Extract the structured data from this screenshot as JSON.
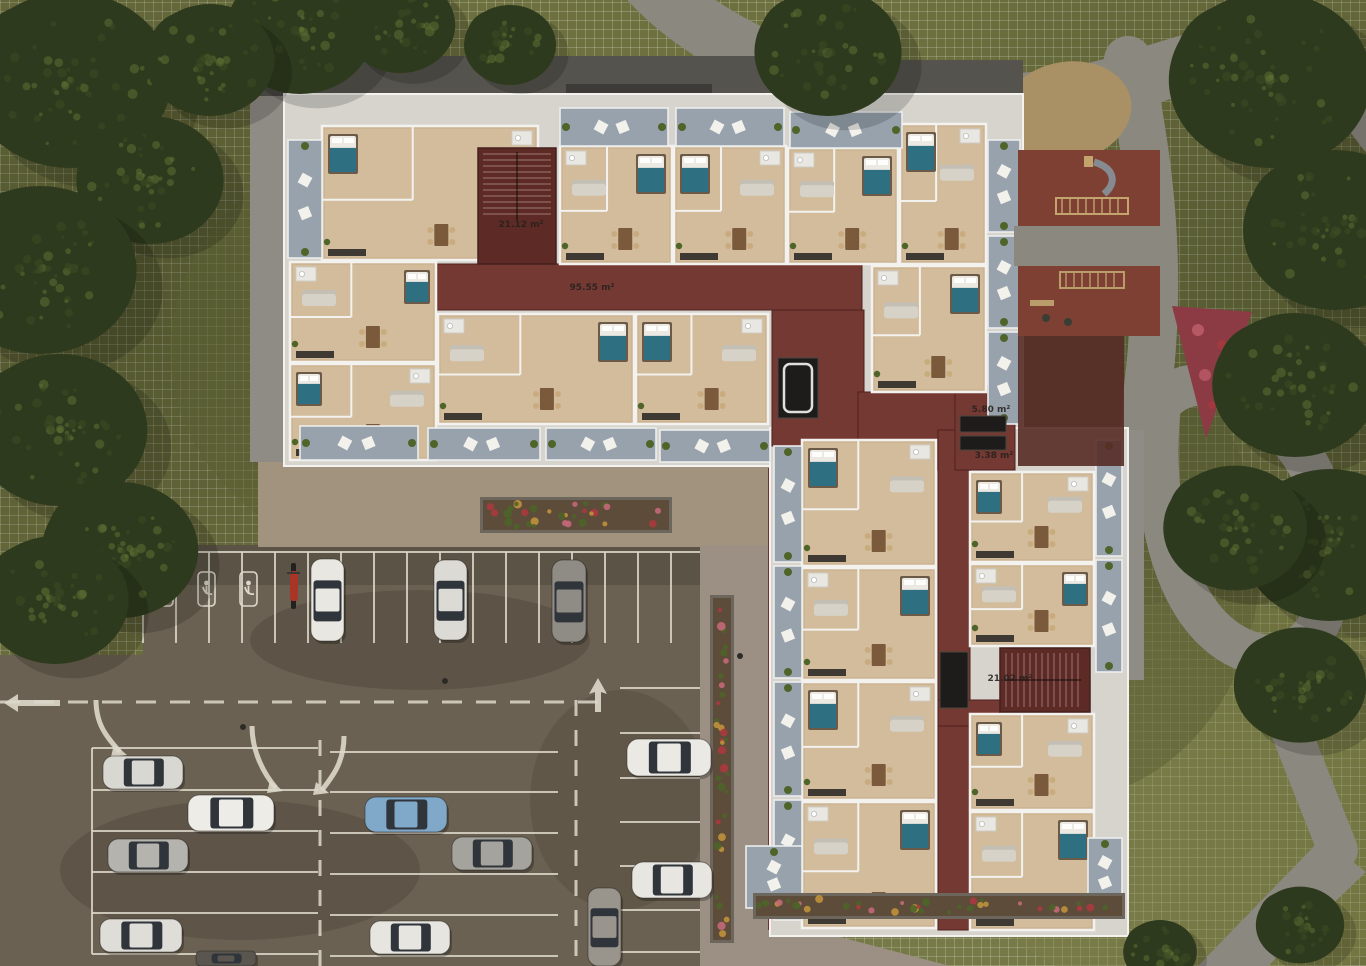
{
  "scene": {
    "width": 1366,
    "height": 966,
    "description": "Aerial 3D architectural rendering of an apartment building floor plan with furnished units, red circulation corridors, playground courtyard, landscaped paths and a car park"
  },
  "palette": {
    "grass": "#6e713f",
    "tree_dark": "#2e3a1d",
    "tree": "#3e4b25",
    "tree_light": "#5e7033",
    "path": "#8b8880",
    "path_dark": "#6f6d66",
    "asphalt": "#6b6152",
    "marking": "#ddd8ca",
    "plaza": "#a2937e",
    "walkway": "#9b9083",
    "wall": "#d7d4cd",
    "wall_line": "#f3f2ef",
    "floor": "#cdb593",
    "floor_light": "#d9c6a7",
    "balcony": "#97a2ac",
    "corridor_red": "#743933",
    "stair_red": "#5d2a26",
    "courtyard_red": "#7f4034",
    "elevator_dark": "#1e1c1a",
    "bed_teal": "#2f6f82",
    "linen_white": "#ece9e2",
    "sofa_gray": "#d6d2c8",
    "wood_brown": "#7a5a3a",
    "kitchen_dark": "#3e3933",
    "soil": "#5c4c39",
    "leaf": "#4e6429",
    "flower_pink": "#c4687a",
    "flower_red": "#a83a3f",
    "flower_yellow": "#c0913c",
    "dirt": "#aa9065",
    "label_text": "#26211d",
    "car_window": "#30353b"
  },
  "area_labels": [
    {
      "text": "95.55 m²",
      "x": 592,
      "y": 290
    },
    {
      "text": "21.12 m²",
      "x": 521,
      "y": 227
    },
    {
      "text": "5.80 m²",
      "x": 991,
      "y": 412
    },
    {
      "text": "3.38 m²",
      "x": 994,
      "y": 458
    },
    {
      "text": "21.02 m²",
      "x": 1010,
      "y": 681
    }
  ],
  "units": [
    {
      "x": 322,
      "y": 126,
      "w": 216,
      "h": 134
    },
    {
      "x": 290,
      "y": 262,
      "w": 146,
      "h": 100
    },
    {
      "x": 290,
      "y": 364,
      "w": 146,
      "h": 96
    },
    {
      "x": 438,
      "y": 314,
      "w": 196,
      "h": 110
    },
    {
      "x": 636,
      "y": 314,
      "w": 132,
      "h": 110
    },
    {
      "x": 560,
      "y": 146,
      "w": 112,
      "h": 118
    },
    {
      "x": 674,
      "y": 146,
      "w": 112,
      "h": 118
    },
    {
      "x": 788,
      "y": 148,
      "w": 110,
      "h": 116
    },
    {
      "x": 900,
      "y": 124,
      "w": 86,
      "h": 140
    },
    {
      "x": 872,
      "y": 266,
      "w": 114,
      "h": 126
    },
    {
      "x": 802,
      "y": 440,
      "w": 134,
      "h": 126
    },
    {
      "x": 802,
      "y": 568,
      "w": 134,
      "h": 112
    },
    {
      "x": 802,
      "y": 682,
      "w": 134,
      "h": 118
    },
    {
      "x": 802,
      "y": 802,
      "w": 134,
      "h": 126
    },
    {
      "x": 970,
      "y": 472,
      "w": 124,
      "h": 90
    },
    {
      "x": 970,
      "y": 564,
      "w": 124,
      "h": 82
    },
    {
      "x": 970,
      "y": 714,
      "w": 124,
      "h": 96
    },
    {
      "x": 970,
      "y": 812,
      "w": 124,
      "h": 118
    }
  ],
  "balconies": [
    {
      "x": 560,
      "y": 108,
      "w": 108,
      "h": 38,
      "o": "h"
    },
    {
      "x": 676,
      "y": 108,
      "w": 108,
      "h": 38,
      "o": "h"
    },
    {
      "x": 790,
      "y": 112,
      "w": 112,
      "h": 36,
      "o": "h"
    },
    {
      "x": 288,
      "y": 140,
      "w": 34,
      "h": 118,
      "o": "v"
    },
    {
      "x": 300,
      "y": 426,
      "w": 118,
      "h": 34,
      "o": "h"
    },
    {
      "x": 428,
      "y": 428,
      "w": 112,
      "h": 32,
      "o": "h"
    },
    {
      "x": 546,
      "y": 428,
      "w": 110,
      "h": 32,
      "o": "h"
    },
    {
      "x": 660,
      "y": 430,
      "w": 110,
      "h": 32,
      "o": "h"
    },
    {
      "x": 988,
      "y": 140,
      "w": 32,
      "h": 92,
      "o": "v"
    },
    {
      "x": 988,
      "y": 236,
      "w": 32,
      "h": 92,
      "o": "v"
    },
    {
      "x": 988,
      "y": 332,
      "w": 32,
      "h": 92,
      "o": "v"
    },
    {
      "x": 774,
      "y": 446,
      "w": 28,
      "h": 116,
      "o": "v"
    },
    {
      "x": 774,
      "y": 566,
      "w": 28,
      "h": 112,
      "o": "v"
    },
    {
      "x": 774,
      "y": 682,
      "w": 28,
      "h": 114,
      "o": "v"
    },
    {
      "x": 774,
      "y": 800,
      "w": 28,
      "h": 120,
      "o": "v"
    },
    {
      "x": 1096,
      "y": 440,
      "w": 26,
      "h": 116,
      "o": "v"
    },
    {
      "x": 1096,
      "y": 560,
      "w": 26,
      "h": 112,
      "o": "v"
    },
    {
      "x": 1088,
      "y": 838,
      "w": 34,
      "h": 72,
      "o": "v"
    },
    {
      "x": 746,
      "y": 846,
      "w": 56,
      "h": 62,
      "o": "v"
    }
  ],
  "corridors": [
    {
      "x": 436,
      "y": 264,
      "w": 426,
      "h": 46
    },
    {
      "x": 772,
      "y": 310,
      "w": 92,
      "h": 136
    },
    {
      "x": 858,
      "y": 392,
      "w": 114,
      "h": 78
    },
    {
      "x": 938,
      "y": 430,
      "w": 32,
      "h": 500
    },
    {
      "x": 938,
      "y": 700,
      "w": 62,
      "h": 26
    },
    {
      "x": 955,
      "y": 386,
      "w": 60,
      "h": 84
    }
  ],
  "stairs": [
    {
      "x": 478,
      "y": 148,
      "w": 78,
      "h": 116,
      "dir": "v"
    },
    {
      "x": 1000,
      "y": 648,
      "w": 90,
      "h": 64,
      "dir": "h"
    }
  ],
  "elevators": [
    {
      "x": 778,
      "y": 358,
      "w": 40,
      "h": 60,
      "tub": true
    },
    {
      "x": 960,
      "y": 416,
      "w": 46,
      "h": 16
    },
    {
      "x": 960,
      "y": 436,
      "w": 46,
      "h": 14
    },
    {
      "x": 940,
      "y": 652,
      "w": 28,
      "h": 56
    }
  ],
  "playground": {
    "zones": [
      {
        "x": 1018,
        "y": 150,
        "w": 142,
        "h": 76,
        "kind": "red"
      },
      {
        "x": 1014,
        "y": 226,
        "w": 156,
        "h": 40,
        "kind": "gray"
      },
      {
        "x": 1018,
        "y": 266,
        "w": 142,
        "h": 70,
        "kind": "red"
      },
      {
        "x": 1018,
        "y": 336,
        "w": 106,
        "h": 130,
        "kind": "red-shadow"
      }
    ]
  },
  "trees": [
    {
      "cx": 70,
      "cy": 80,
      "r": 110
    },
    {
      "cx": 150,
      "cy": 180,
      "r": 80
    },
    {
      "cx": 40,
      "cy": 270,
      "r": 105
    },
    {
      "cx": 60,
      "cy": 430,
      "r": 95
    },
    {
      "cx": 120,
      "cy": 550,
      "r": 85
    },
    {
      "cx": 55,
      "cy": 600,
      "r": 80
    },
    {
      "cx": 300,
      "cy": 30,
      "r": 80
    },
    {
      "cx": 210,
      "cy": 60,
      "r": 70
    },
    {
      "cx": 400,
      "cy": 25,
      "r": 60
    },
    {
      "cx": 510,
      "cy": 45,
      "r": 50
    },
    {
      "cx": 828,
      "cy": 52,
      "r": 80
    },
    {
      "cx": 1270,
      "cy": 80,
      "r": 110
    },
    {
      "cx": 1335,
      "cy": 230,
      "r": 100
    },
    {
      "cx": 1295,
      "cy": 385,
      "r": 90
    },
    {
      "cx": 1330,
      "cy": 545,
      "r": 95
    },
    {
      "cx": 1300,
      "cy": 685,
      "r": 72
    },
    {
      "cx": 1235,
      "cy": 528,
      "r": 78
    },
    {
      "cx": 1300,
      "cy": 925,
      "r": 48
    },
    {
      "cx": 1160,
      "cy": 952,
      "r": 40
    }
  ],
  "planters": [
    {
      "x": 483,
      "y": 500,
      "w": 186,
      "h": 30,
      "kind": "planter-box"
    },
    {
      "x": 713,
      "y": 598,
      "w": 18,
      "h": 342,
      "kind": "flower-strip"
    },
    {
      "x": 756,
      "y": 896,
      "w": 366,
      "h": 20,
      "kind": "flower-strip"
    }
  ],
  "cars": [
    {
      "x": 311,
      "y": 559,
      "w": 33,
      "h": 82,
      "c": "#e9e7e2"
    },
    {
      "x": 434,
      "y": 560,
      "w": 33,
      "h": 80,
      "c": "#dcdad4"
    },
    {
      "x": 552,
      "y": 560,
      "w": 34,
      "h": 82,
      "c": "#8f8c85"
    },
    {
      "x": 103,
      "y": 756,
      "w": 80,
      "h": 33,
      "c": "#d9d7d1"
    },
    {
      "x": 188,
      "y": 795,
      "w": 86,
      "h": 36,
      "c": "#eeece7"
    },
    {
      "x": 108,
      "y": 839,
      "w": 80,
      "h": 33,
      "c": "#b5b3ad"
    },
    {
      "x": 100,
      "y": 919,
      "w": 82,
      "h": 33,
      "c": "#dfddd7"
    },
    {
      "x": 365,
      "y": 797,
      "w": 82,
      "h": 35,
      "c": "#7fa8c9"
    },
    {
      "x": 452,
      "y": 837,
      "w": 80,
      "h": 33,
      "c": "#a5a39d"
    },
    {
      "x": 370,
      "y": 921,
      "w": 80,
      "h": 33,
      "c": "#e7e5e0"
    },
    {
      "x": 627,
      "y": 739,
      "w": 84,
      "h": 37,
      "c": "#ebe9e4"
    },
    {
      "x": 632,
      "y": 862,
      "w": 80,
      "h": 36,
      "c": "#e8e6e1"
    },
    {
      "x": 588,
      "y": 888,
      "w": 33,
      "h": 78,
      "c": "#99958d"
    },
    {
      "x": 196,
      "y": 951,
      "w": 60,
      "h": 15,
      "c": "#5a564f"
    }
  ],
  "motorcycle": {
    "x": 288,
    "y": 563,
    "w": 13,
    "h": 46,
    "c": "#a93527"
  },
  "accessible_spots": [
    {
      "x": 156,
      "y": 572
    },
    {
      "x": 198,
      "y": 572
    },
    {
      "x": 240,
      "y": 572
    }
  ]
}
